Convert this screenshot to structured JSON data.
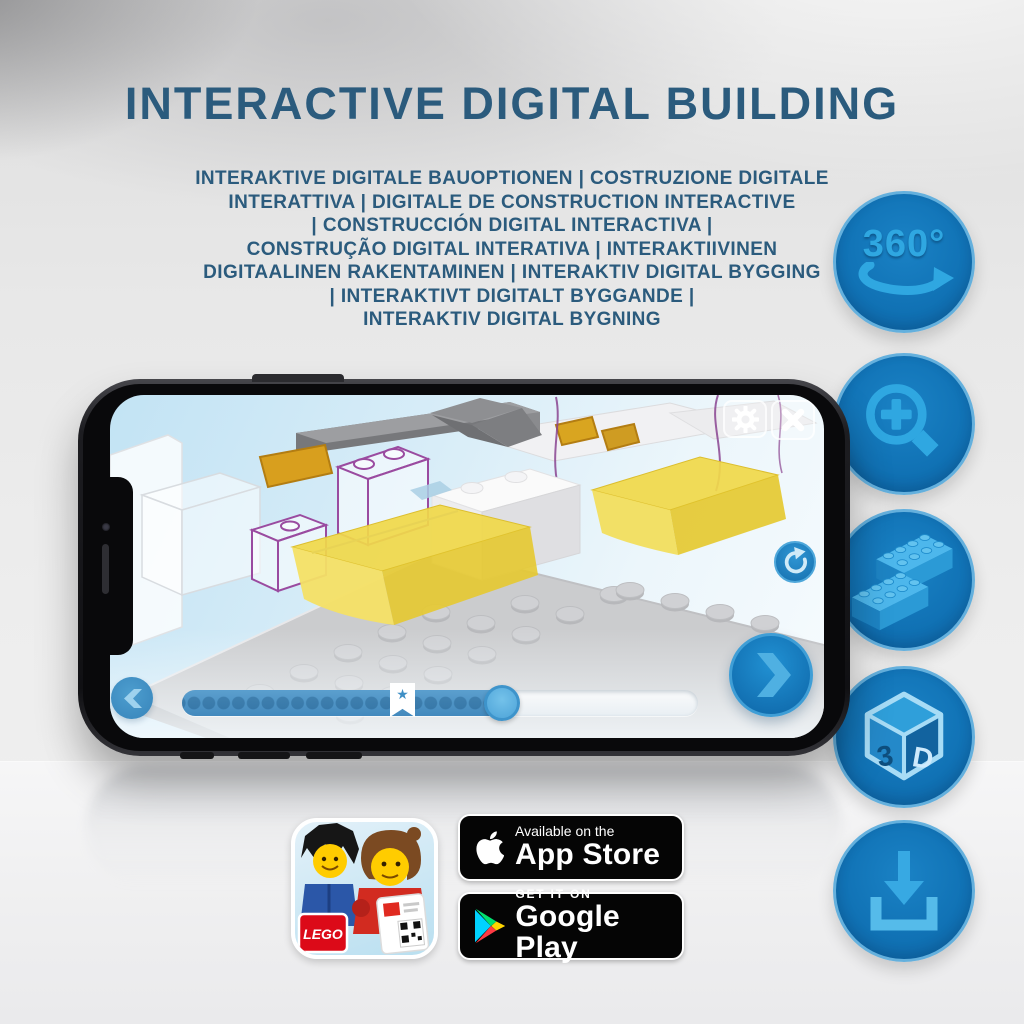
{
  "header": {
    "title": "INTERACTIVE DIGITAL BUILDING",
    "subtitle_lines": [
      "INTERAKTIVE DIGITALE BAUOPTIONEN | COSTRUZIONE DIGITALE",
      "INTERATTIVA | DIGITALE DE CONSTRUCTION INTERACTIVE",
      "| CONSTRUCCIÓN DIGITAL INTERACTIVA |",
      "CONSTRUÇÃO DIGITAL INTERATIVA | INTERAKTIIVINEN",
      "DIGITAALINEN RAKENTAMINEN | INTERAKTIV DIGITAL BYGGING",
      "| INTERAKTIVT DIGITALT BYGGANDE |",
      "INTERAKTIV DIGITAL BYGNING"
    ]
  },
  "features": {
    "rotation_label": "360°",
    "cube_left": "3",
    "cube_right": "D",
    "icon_names": [
      "360-rotation",
      "zoom-in",
      "brick-steps",
      "3d-view",
      "download"
    ]
  },
  "app_ui": {
    "star_glyph": "★"
  },
  "store": {
    "lego_logo": "LEGO",
    "apple_line1": "Available on the",
    "apple_line2": "App Store",
    "google_line1": "GET IT ON",
    "google_line2": "Google Play"
  },
  "colors": {
    "heading_blue": "#2b5b7d",
    "circle_blue": "#1173b6",
    "circle_ring": "#64b0dd",
    "icon_light_blue": "#2fa7e1",
    "app_button_blue": "#1372b4",
    "bar_fill_blue": "#4389bd",
    "yellow_brick": "#f0d84a",
    "ghost_outline_purple": "#9a4ba0",
    "badge_black": "#050505"
  }
}
